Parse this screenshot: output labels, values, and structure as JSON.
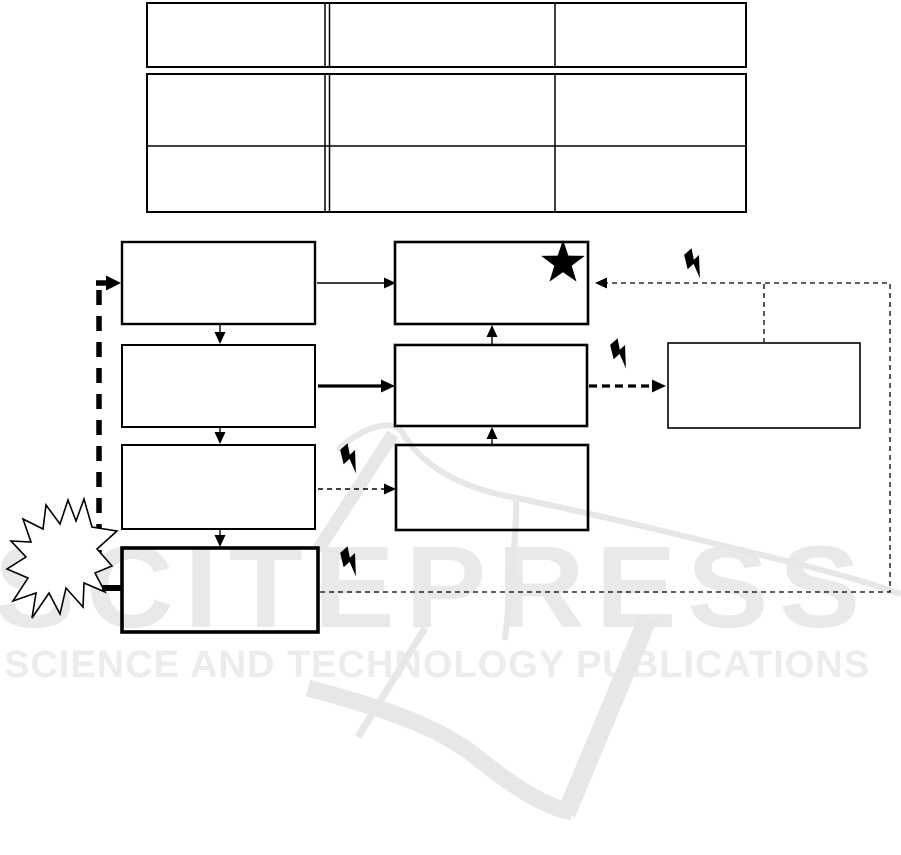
{
  "page": {
    "width": 901,
    "height": 855,
    "background": "#ffffff",
    "ink_color": "#000000"
  },
  "watermark": {
    "brand": "SCITEPRESS",
    "tagline": "SCIENCE AND TECHNOLOGY PUBLICATIONS",
    "text_color": "#e9e9e9",
    "logo_color": "#e7e7e7"
  },
  "table": {
    "columns": 3,
    "header_rows": 1,
    "body_rows": 2,
    "header_cells": [
      "",
      "",
      ""
    ],
    "body_cells": [
      [
        "",
        "",
        ""
      ],
      [
        "",
        "",
        ""
      ]
    ],
    "style": "double rule after first column, header separated from body"
  },
  "flowchart": {
    "boxes": [
      {
        "id": "box-1",
        "label": "",
        "position": "row1-left"
      },
      {
        "id": "box-2",
        "label": "",
        "position": "row1-right",
        "badge": "star"
      },
      {
        "id": "box-3",
        "label": "",
        "position": "row2-left"
      },
      {
        "id": "box-4",
        "label": "",
        "position": "row2-right"
      },
      {
        "id": "box-5",
        "label": "",
        "position": "row3-left"
      },
      {
        "id": "box-6",
        "label": "",
        "position": "row3-right"
      },
      {
        "id": "box-7",
        "label": "",
        "position": "row4-left",
        "border": "thick"
      },
      {
        "id": "box-8",
        "label": "",
        "position": "far-right"
      }
    ],
    "icons": {
      "star-icon": "★",
      "lightning-icon": "⚡",
      "burst-icon": "✴"
    },
    "lightning_count": 4
  }
}
